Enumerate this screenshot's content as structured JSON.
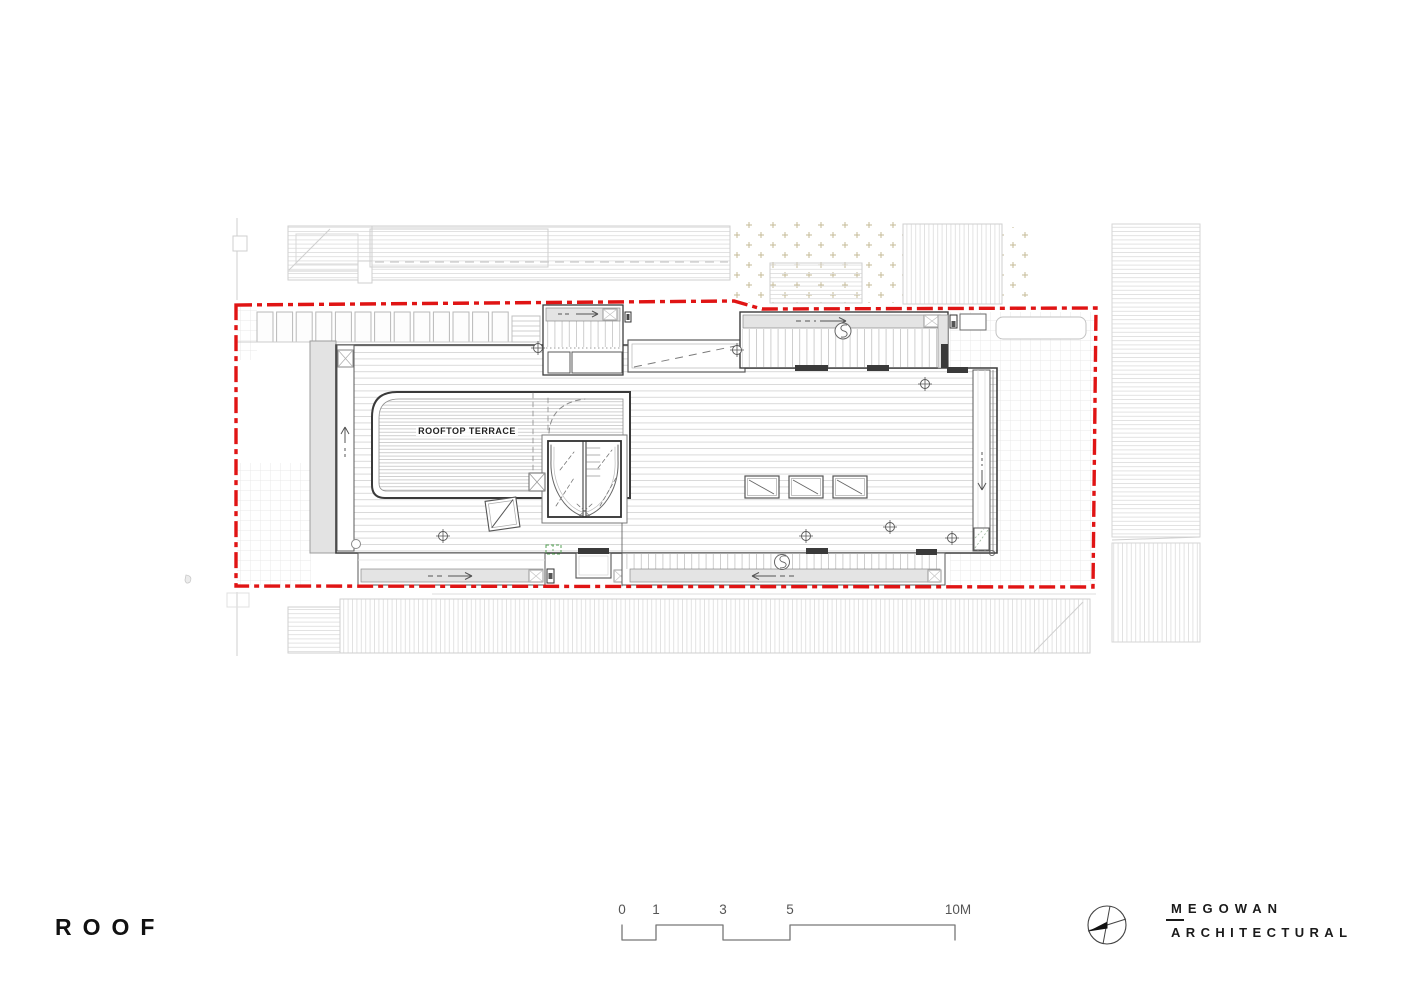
{
  "sheet": {
    "title": "ROOF",
    "brand": {
      "line1": "MEGOWAN",
      "line2": "ARCHITECTURAL"
    },
    "scale_bar": {
      "labels": [
        "0",
        "1",
        "3",
        "5",
        "10M"
      ],
      "unit": "metres"
    }
  },
  "plan": {
    "labels": {
      "terrace": "ROOFTOP TERRACE"
    },
    "symbols": {
      "north_arrow": "north-arrow-icon",
      "drain": "s-drain-icon",
      "flow_arrow": "flow-direction-arrow-icon",
      "survey_mark": "crosshair-survey-mark-icon",
      "skylight": "skylight-diagonal-icon"
    },
    "colors": {
      "site_boundary_red": "#e01414",
      "building_line": "#3d3d3d",
      "context_line": "#cfcfcf",
      "gutter_fill": "#e4e4e4",
      "wall_fill": "#e3e3e3",
      "marker_green": "#55a055",
      "garden_dot_tan": "#c6bb97"
    }
  }
}
